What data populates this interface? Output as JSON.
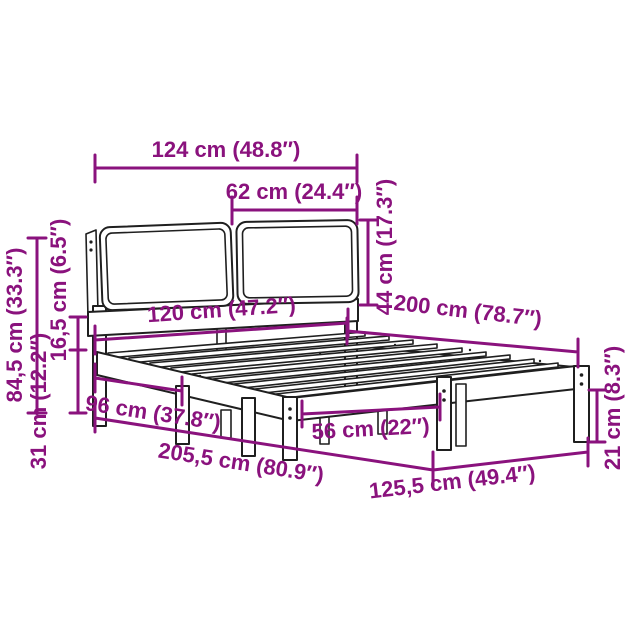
{
  "colors": {
    "dimension_line": "#8A127D",
    "outline": "#1F1F1F",
    "background": "#FFFFFF"
  },
  "dimensions": {
    "total_width": "124 cm (48.8″)",
    "headboard_panel_width": "62 cm (24.4″)",
    "headboard_panel_height": "44 cm (17.3″)",
    "headboard_height": "84,5 cm (33.3″)",
    "side_rail_height": "16,5 cm (6.5″)",
    "under_bed_clearance": "31 cm (12.2″)",
    "bed_width": "120 cm (47.2″)",
    "bed_length": "200 cm (78.7″)",
    "head_to_center_leg": "96 cm (37.8″)",
    "total_length": "205,5 cm (80.9″)",
    "foot_leg_spacing": "56 cm (22″)",
    "overall_width": "125,5 cm (49.4″)",
    "leg_height": "21 cm (8.3″)"
  }
}
